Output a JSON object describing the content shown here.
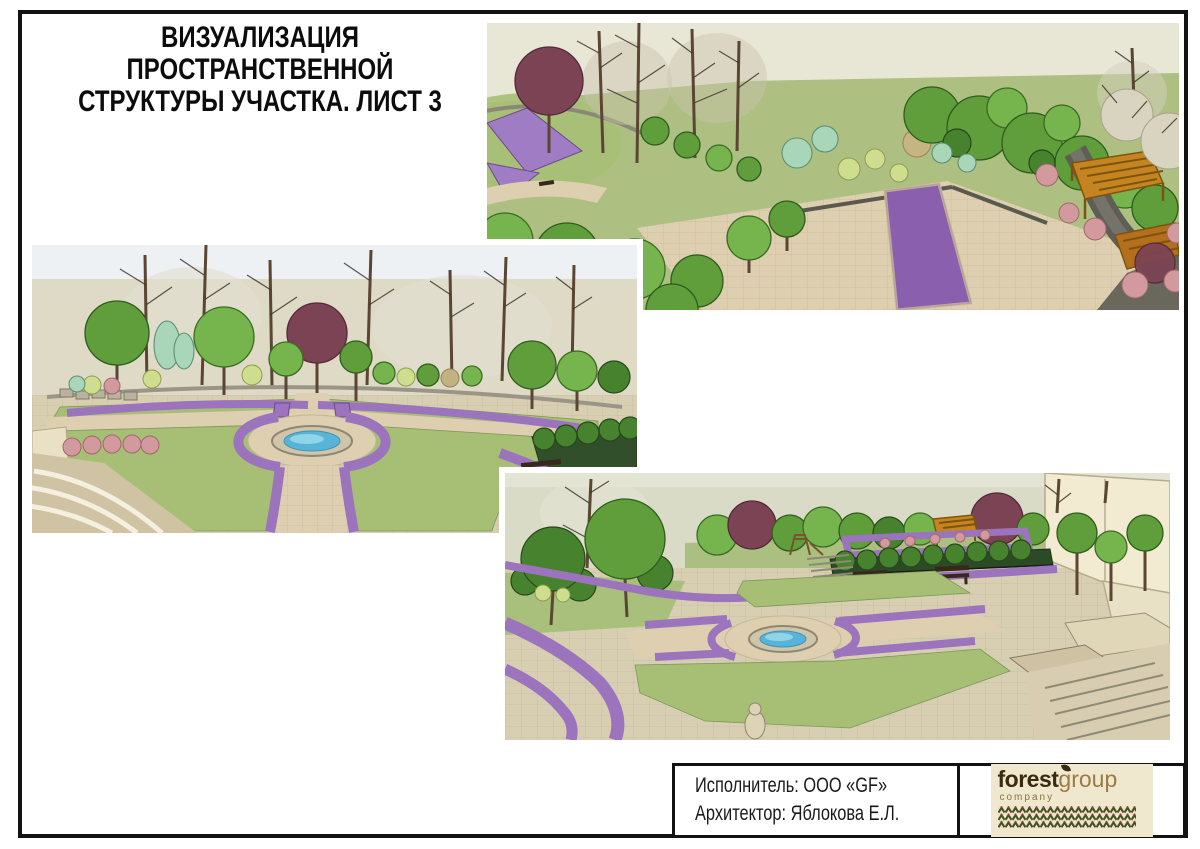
{
  "sheet": {
    "title_line1": "ВИЗУАЛИЗАЦИЯ ПРОСТРАНСТВЕННОЙ",
    "title_line2": "СТРУКТУРЫ УЧАСТКА. ЛИСТ 3"
  },
  "footer": {
    "contractor": "Исполнитель: ООО «GF»",
    "architect": "Архитектор: Яблокова Е.Л."
  },
  "logo": {
    "forest": "forest",
    "group": "group",
    "company": "company"
  },
  "colors": {
    "lawn_green": "#a6bf75",
    "flower_purple": "#9b74bd",
    "paving_beige": "#decfb0",
    "water_blue": "#57b4d6",
    "pergola_orange": "#c5841f",
    "maroon_tree": "#7c4355",
    "logo_dark_brown": "#3a2a10",
    "logo_light_brown": "#9c7b42",
    "logo_cream": "#efe8cf",
    "frame_black": "#121212"
  }
}
